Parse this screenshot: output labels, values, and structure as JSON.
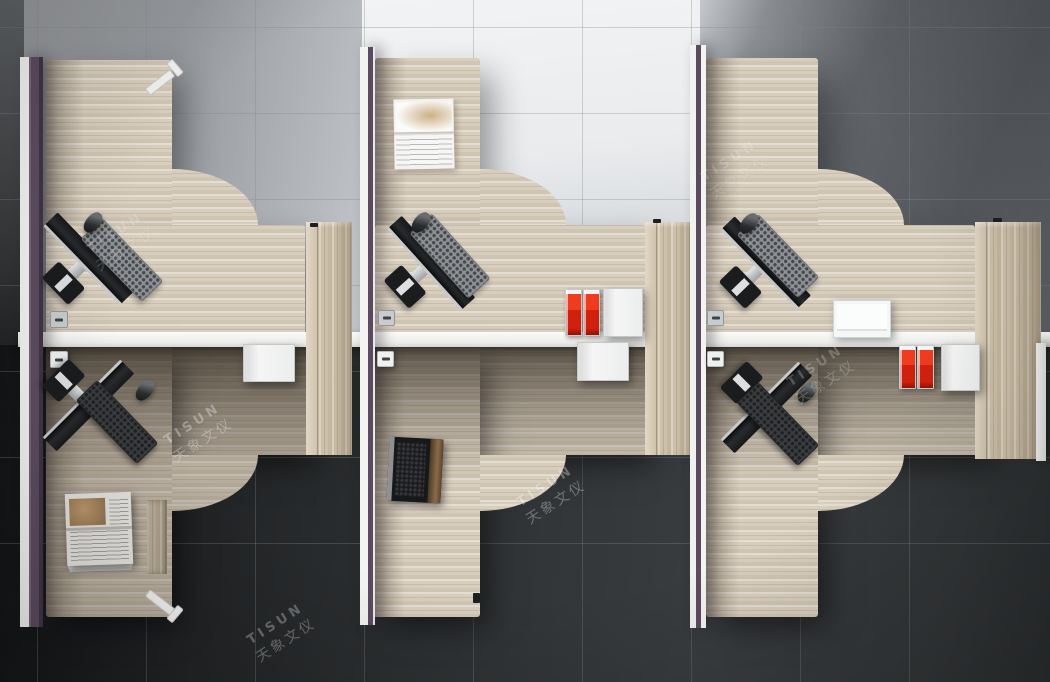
{
  "watermark": {
    "brand": "TISUN",
    "cjk": "天象文仪"
  },
  "palette": {
    "desk_wood": "#d8cebe",
    "cabinet_wood": "#cdc0a9",
    "partition_white": "#f3f3f1",
    "partition_purple": "#5c4c60",
    "spine_white": "#f5f5f3",
    "floor_light": "#f2f3f4",
    "floor_mid_gray": "#8a8d91",
    "floor_dark": "#2e3133",
    "accent_red": "#d0200e",
    "device_black": "#1b1c1e",
    "silver": "#c7c9cb"
  },
  "scene": {
    "objects": [
      {
        "t": "wood",
        "x": 46,
        "y": 60,
        "w": 126,
        "h": 275,
        "cls": "shade-left top-shadow",
        "name": "desk1-return"
      },
      {
        "t": "wood",
        "x": 46,
        "y": 225,
        "w": 259,
        "h": 110,
        "cls": "top-shadow",
        "name": "desk1-main"
      },
      {
        "t": "fillet",
        "x": 172,
        "y": 169,
        "w": 86,
        "h": 56,
        "v": "top",
        "name": "desk1-curve"
      },
      {
        "t": "wood",
        "x": 375,
        "y": 58,
        "w": 105,
        "h": 277,
        "cls": "shade-left top-shadow",
        "name": "desk2-return"
      },
      {
        "t": "wood",
        "x": 375,
        "y": 225,
        "w": 270,
        "h": 110,
        "cls": "top-shadow",
        "name": "desk2-main"
      },
      {
        "t": "fillet",
        "x": 480,
        "y": 169,
        "w": 86,
        "h": 56,
        "v": "top",
        "name": "desk2-curve"
      },
      {
        "t": "wood",
        "x": 706,
        "y": 58,
        "w": 112,
        "h": 277,
        "cls": "shade-left top-shadow",
        "name": "desk3-return"
      },
      {
        "t": "wood",
        "x": 706,
        "y": 225,
        "w": 269,
        "h": 110,
        "cls": "top-shadow",
        "name": "desk3-main"
      },
      {
        "t": "fillet",
        "x": 818,
        "y": 169,
        "w": 86,
        "h": 56,
        "v": "top",
        "name": "desk3-curve"
      },
      {
        "t": "wood",
        "x": 46,
        "y": 347,
        "w": 264,
        "h": 108,
        "cls": "shade-top dim bot-shadow",
        "name": "desk4-main"
      },
      {
        "t": "wood",
        "x": 46,
        "y": 347,
        "w": 126,
        "h": 270,
        "cls": "shade-left shade-top dim bot-shadow",
        "name": "desk4-return"
      },
      {
        "t": "fillet",
        "x": 172,
        "y": 455,
        "w": 86,
        "h": 56,
        "v": "bottom",
        "cls": "dim",
        "name": "desk4-curve"
      },
      {
        "t": "wood",
        "x": 373,
        "y": 347,
        "w": 274,
        "h": 108,
        "cls": "shade-top bot-shadow",
        "name": "desk5-main"
      },
      {
        "t": "wood",
        "x": 373,
        "y": 347,
        "w": 107,
        "h": 270,
        "cls": "shade-left shade-top bot-shadow",
        "name": "desk5-return"
      },
      {
        "t": "fillet",
        "x": 480,
        "y": 455,
        "w": 86,
        "h": 56,
        "v": "bottom",
        "name": "desk5-curve"
      },
      {
        "t": "wood",
        "x": 706,
        "y": 347,
        "w": 284,
        "h": 108,
        "cls": "shade-top bot-shadow",
        "name": "desk6-main"
      },
      {
        "t": "wood",
        "x": 706,
        "y": 347,
        "w": 112,
        "h": 270,
        "cls": "shade-left shade-top bot-shadow",
        "name": "desk6-return"
      },
      {
        "t": "fillet",
        "x": 818,
        "y": 455,
        "w": 86,
        "h": 56,
        "v": "bottom",
        "name": "desk6-curve"
      },
      {
        "t": "wdrawer",
        "x": 147,
        "y": 500,
        "w": 20,
        "h": 74,
        "name": "under-desk-drawer"
      },
      {
        "t": "cab",
        "x": 306,
        "y": 222,
        "w": 46,
        "h": 233,
        "name": "storage-cabinet-1"
      },
      {
        "t": "cab",
        "x": 645,
        "y": 222,
        "w": 55,
        "h": 233,
        "name": "storage-cabinet-2"
      },
      {
        "t": "cab",
        "x": 975,
        "y": 222,
        "w": 66,
        "h": 237,
        "name": "storage-cabinet-3"
      },
      {
        "t": "spine",
        "x": 18,
        "y": 332,
        "w": 1032,
        "h": 15,
        "name": "center-divider"
      },
      {
        "t": "part",
        "x": 20,
        "y": 57,
        "w": 23,
        "h": 570,
        "v": "left",
        "name": "partition-left"
      },
      {
        "t": "part",
        "x": 360,
        "y": 47,
        "w": 15,
        "h": 578,
        "v": "mid",
        "name": "partition-mid"
      },
      {
        "t": "part",
        "x": 690,
        "y": 45,
        "w": 16,
        "h": 583,
        "v": "mid2",
        "name": "partition-right"
      },
      {
        "t": "wpanel",
        "x": 1036,
        "y": 343,
        "w": 10,
        "h": 118,
        "name": "end-panel"
      },
      {
        "t": "leg",
        "x": 144,
        "y": 62,
        "v": "top",
        "name": "desk1-leg"
      },
      {
        "t": "leg",
        "x": 144,
        "y": 584,
        "v": "bottom",
        "name": "desk4-leg"
      },
      {
        "t": "grom",
        "x": 50,
        "y": 311,
        "w": 16,
        "h": 15,
        "v": "light",
        "name": "cable-grommet-1"
      },
      {
        "t": "grom",
        "x": 378,
        "y": 310,
        "w": 15,
        "h": 14,
        "v": "light",
        "name": "cable-grommet-2"
      },
      {
        "t": "grom",
        "x": 707,
        "y": 310,
        "w": 15,
        "h": 14,
        "v": "light",
        "name": "cable-grommet-3"
      },
      {
        "t": "grom",
        "x": 50,
        "y": 351,
        "w": 16,
        "h": 15,
        "v": "white",
        "name": "cable-grommet-4"
      },
      {
        "t": "grom",
        "x": 377,
        "y": 351,
        "w": 15,
        "h": 14,
        "v": "white",
        "name": "cable-grommet-5"
      },
      {
        "t": "grom",
        "x": 707,
        "y": 351,
        "w": 15,
        "h": 14,
        "v": "white",
        "name": "cable-grommet-6"
      },
      {
        "t": "mon",
        "x": 75,
        "y": 272,
        "r": 46,
        "name": "monitor-1"
      },
      {
        "t": "mon",
        "x": 417,
        "y": 276,
        "r": 48,
        "name": "monitor-2"
      },
      {
        "t": "mon",
        "x": 752,
        "y": 276,
        "r": 46,
        "name": "monitor-3"
      },
      {
        "t": "mon",
        "x": 75,
        "y": 392,
        "r": 135,
        "name": "monitor-4"
      },
      {
        "t": "mon",
        "x": 753,
        "y": 394,
        "r": 135,
        "name": "monitor-6"
      },
      {
        "t": "kb",
        "x": 121,
        "y": 259,
        "r": 46,
        "v": "light",
        "name": "keyboard-1"
      },
      {
        "t": "kb",
        "x": 449,
        "y": 255,
        "r": 48,
        "v": "light",
        "name": "keyboard-2"
      },
      {
        "t": "kb",
        "x": 777,
        "y": 255,
        "r": 46,
        "v": "light",
        "name": "keyboard-3"
      },
      {
        "t": "kb",
        "x": 116,
        "y": 421,
        "r": 46,
        "v": "dark",
        "name": "keyboard-4"
      },
      {
        "t": "kb",
        "x": 777,
        "y": 423,
        "r": 46,
        "v": "dark",
        "name": "keyboard-6"
      },
      {
        "t": "mouse",
        "x": 93,
        "y": 222,
        "r": 40,
        "name": "mouse-1"
      },
      {
        "t": "mouse",
        "x": 421,
        "y": 222,
        "r": 40,
        "name": "mouse-2"
      },
      {
        "t": "mouse",
        "x": 749,
        "y": 223,
        "r": 40,
        "name": "mouse-3"
      },
      {
        "t": "mouse",
        "x": 145,
        "y": 390,
        "r": 40,
        "name": "mouse-4"
      },
      {
        "t": "mouse",
        "x": 807,
        "y": 392,
        "r": 40,
        "name": "mouse-6"
      },
      {
        "t": "laptop",
        "x": 388,
        "y": 438,
        "w": 54,
        "h": 64,
        "r": 3,
        "name": "laptop"
      },
      {
        "t": "mag",
        "x": 394,
        "y": 99,
        "w": 60,
        "h": 70,
        "r": -1,
        "name": "open-magazine"
      },
      {
        "t": "news",
        "x": 66,
        "y": 493,
        "w": 66,
        "h": 72,
        "r": -2,
        "name": "newspaper"
      },
      {
        "t": "file",
        "x": 565,
        "y": 289,
        "w": 15,
        "h": 45,
        "name": "red-file-1"
      },
      {
        "t": "file",
        "x": 583,
        "y": 289,
        "w": 15,
        "h": 45,
        "name": "red-file-2"
      },
      {
        "t": "wbox",
        "x": 603,
        "y": 288,
        "w": 38,
        "h": 47,
        "name": "white-box-1"
      },
      {
        "t": "file",
        "x": 899,
        "y": 345,
        "w": 15,
        "h": 42,
        "name": "red-file-3"
      },
      {
        "t": "file",
        "x": 917,
        "y": 345,
        "w": 15,
        "h": 42,
        "name": "red-file-4"
      },
      {
        "t": "wbox",
        "x": 941,
        "y": 344,
        "w": 37,
        "h": 45,
        "name": "white-box-2"
      },
      {
        "t": "stack",
        "x": 833,
        "y": 300,
        "w": 56,
        "h": 36,
        "name": "paper-stack"
      },
      {
        "t": "wbox",
        "x": 243,
        "y": 344,
        "w": 50,
        "h": 36,
        "name": "hanging-drawer-1"
      },
      {
        "t": "wbox",
        "x": 577,
        "y": 342,
        "w": 50,
        "h": 37,
        "name": "hanging-drawer-2"
      },
      {
        "t": "nub",
        "x": 310,
        "y": 223,
        "w": 8,
        "h": 4,
        "name": "cabinet-1-handle"
      },
      {
        "t": "nub",
        "x": 653,
        "y": 219,
        "w": 8,
        "h": 4,
        "name": "cabinet-2-handle"
      },
      {
        "t": "nub",
        "x": 993,
        "y": 218,
        "w": 9,
        "h": 4,
        "name": "cabinet-3-handle"
      },
      {
        "t": "nub",
        "x": 473,
        "y": 593,
        "w": 7,
        "h": 10,
        "name": "desk5-edge-handle"
      },
      {
        "t": "wm",
        "x": 128,
        "y": 252,
        "o": 0.18,
        "name": "watermark-desk1"
      },
      {
        "t": "wm",
        "x": 742,
        "y": 180,
        "o": 0.16,
        "name": "watermark-desk3"
      },
      {
        "t": "wm",
        "x": 205,
        "y": 443,
        "o": 0.3,
        "name": "watermark-floor-left"
      },
      {
        "t": "wm",
        "x": 558,
        "y": 505,
        "o": 0.3,
        "name": "watermark-floor-mid"
      },
      {
        "t": "wm",
        "x": 828,
        "y": 385,
        "o": 0.22,
        "name": "watermark-desk6"
      },
      {
        "t": "wm",
        "x": 288,
        "y": 643,
        "o": 0.28,
        "name": "watermark-floor-corner"
      }
    ]
  }
}
